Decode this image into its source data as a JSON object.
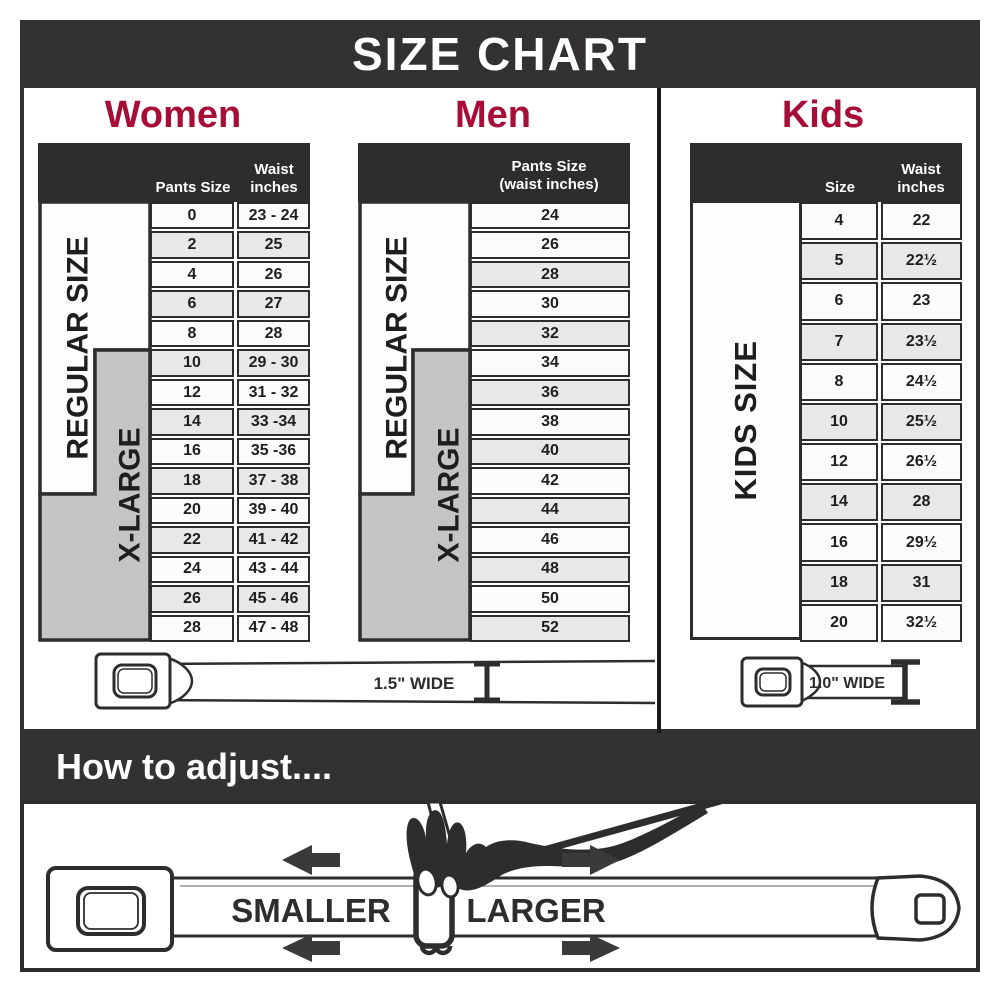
{
  "title": "SIZE CHART",
  "colors": {
    "banner_charcoal": "#333132",
    "accent_crimson": "#a60d37",
    "row_white": "#fcfcfc",
    "row_gray": "#e8e8e8",
    "xlarge_gray": "#c4c4c4",
    "border_dark": "#2e2d2e"
  },
  "women": {
    "heading": "Women",
    "col1_header": "Pants Size",
    "col2_header": "Waist\ninches",
    "regular_label": "REGULAR SIZE",
    "xlarge_label": "X-LARGE",
    "rows": [
      [
        "0",
        "23 - 24"
      ],
      [
        "2",
        "25"
      ],
      [
        "4",
        "26"
      ],
      [
        "6",
        "27"
      ],
      [
        "8",
        "28"
      ],
      [
        "10",
        "29 - 30"
      ],
      [
        "12",
        "31 - 32"
      ],
      [
        "14",
        "33 -34"
      ],
      [
        "16",
        "35 -36"
      ],
      [
        "18",
        "37 - 38"
      ],
      [
        "20",
        "39 - 40"
      ],
      [
        "22",
        "41 - 42"
      ],
      [
        "24",
        "43 - 44"
      ],
      [
        "26",
        "45 - 46"
      ],
      [
        "28",
        "47 - 48"
      ]
    ]
  },
  "men": {
    "heading": "Men",
    "col_header": "Pants Size\n(waist inches)",
    "regular_label": "REGULAR SIZE",
    "xlarge_label": "X-LARGE",
    "rows": [
      [
        "24"
      ],
      [
        "26"
      ],
      [
        "28"
      ],
      [
        "30"
      ],
      [
        "32"
      ],
      [
        "34"
      ],
      [
        "36"
      ],
      [
        "38"
      ],
      [
        "40"
      ],
      [
        "42"
      ],
      [
        "44"
      ],
      [
        "46"
      ],
      [
        "48"
      ],
      [
        "50"
      ],
      [
        "52"
      ]
    ]
  },
  "kids": {
    "heading": "Kids",
    "col1_header": "Size",
    "col2_header": "Waist\ninches",
    "size_label": "KIDS SIZE",
    "note": "Note:\nNot intended for\nToddler Sizes (T)",
    "rows": [
      [
        "4",
        "22"
      ],
      [
        "5",
        "22½"
      ],
      [
        "6",
        "23"
      ],
      [
        "7",
        "23½"
      ],
      [
        "8",
        "24½"
      ],
      [
        "10",
        "25½"
      ],
      [
        "12",
        "26½"
      ],
      [
        "14",
        "28"
      ],
      [
        "16",
        "29½"
      ],
      [
        "18",
        "31"
      ],
      [
        "20",
        "32½"
      ]
    ]
  },
  "belts": {
    "adult_width_label": "1.5\" WIDE",
    "kids_width_label": "1.0\" WIDE"
  },
  "adjust": {
    "heading": "How to adjust....",
    "smaller_label": "SMALLER",
    "larger_label": "LARGER"
  }
}
